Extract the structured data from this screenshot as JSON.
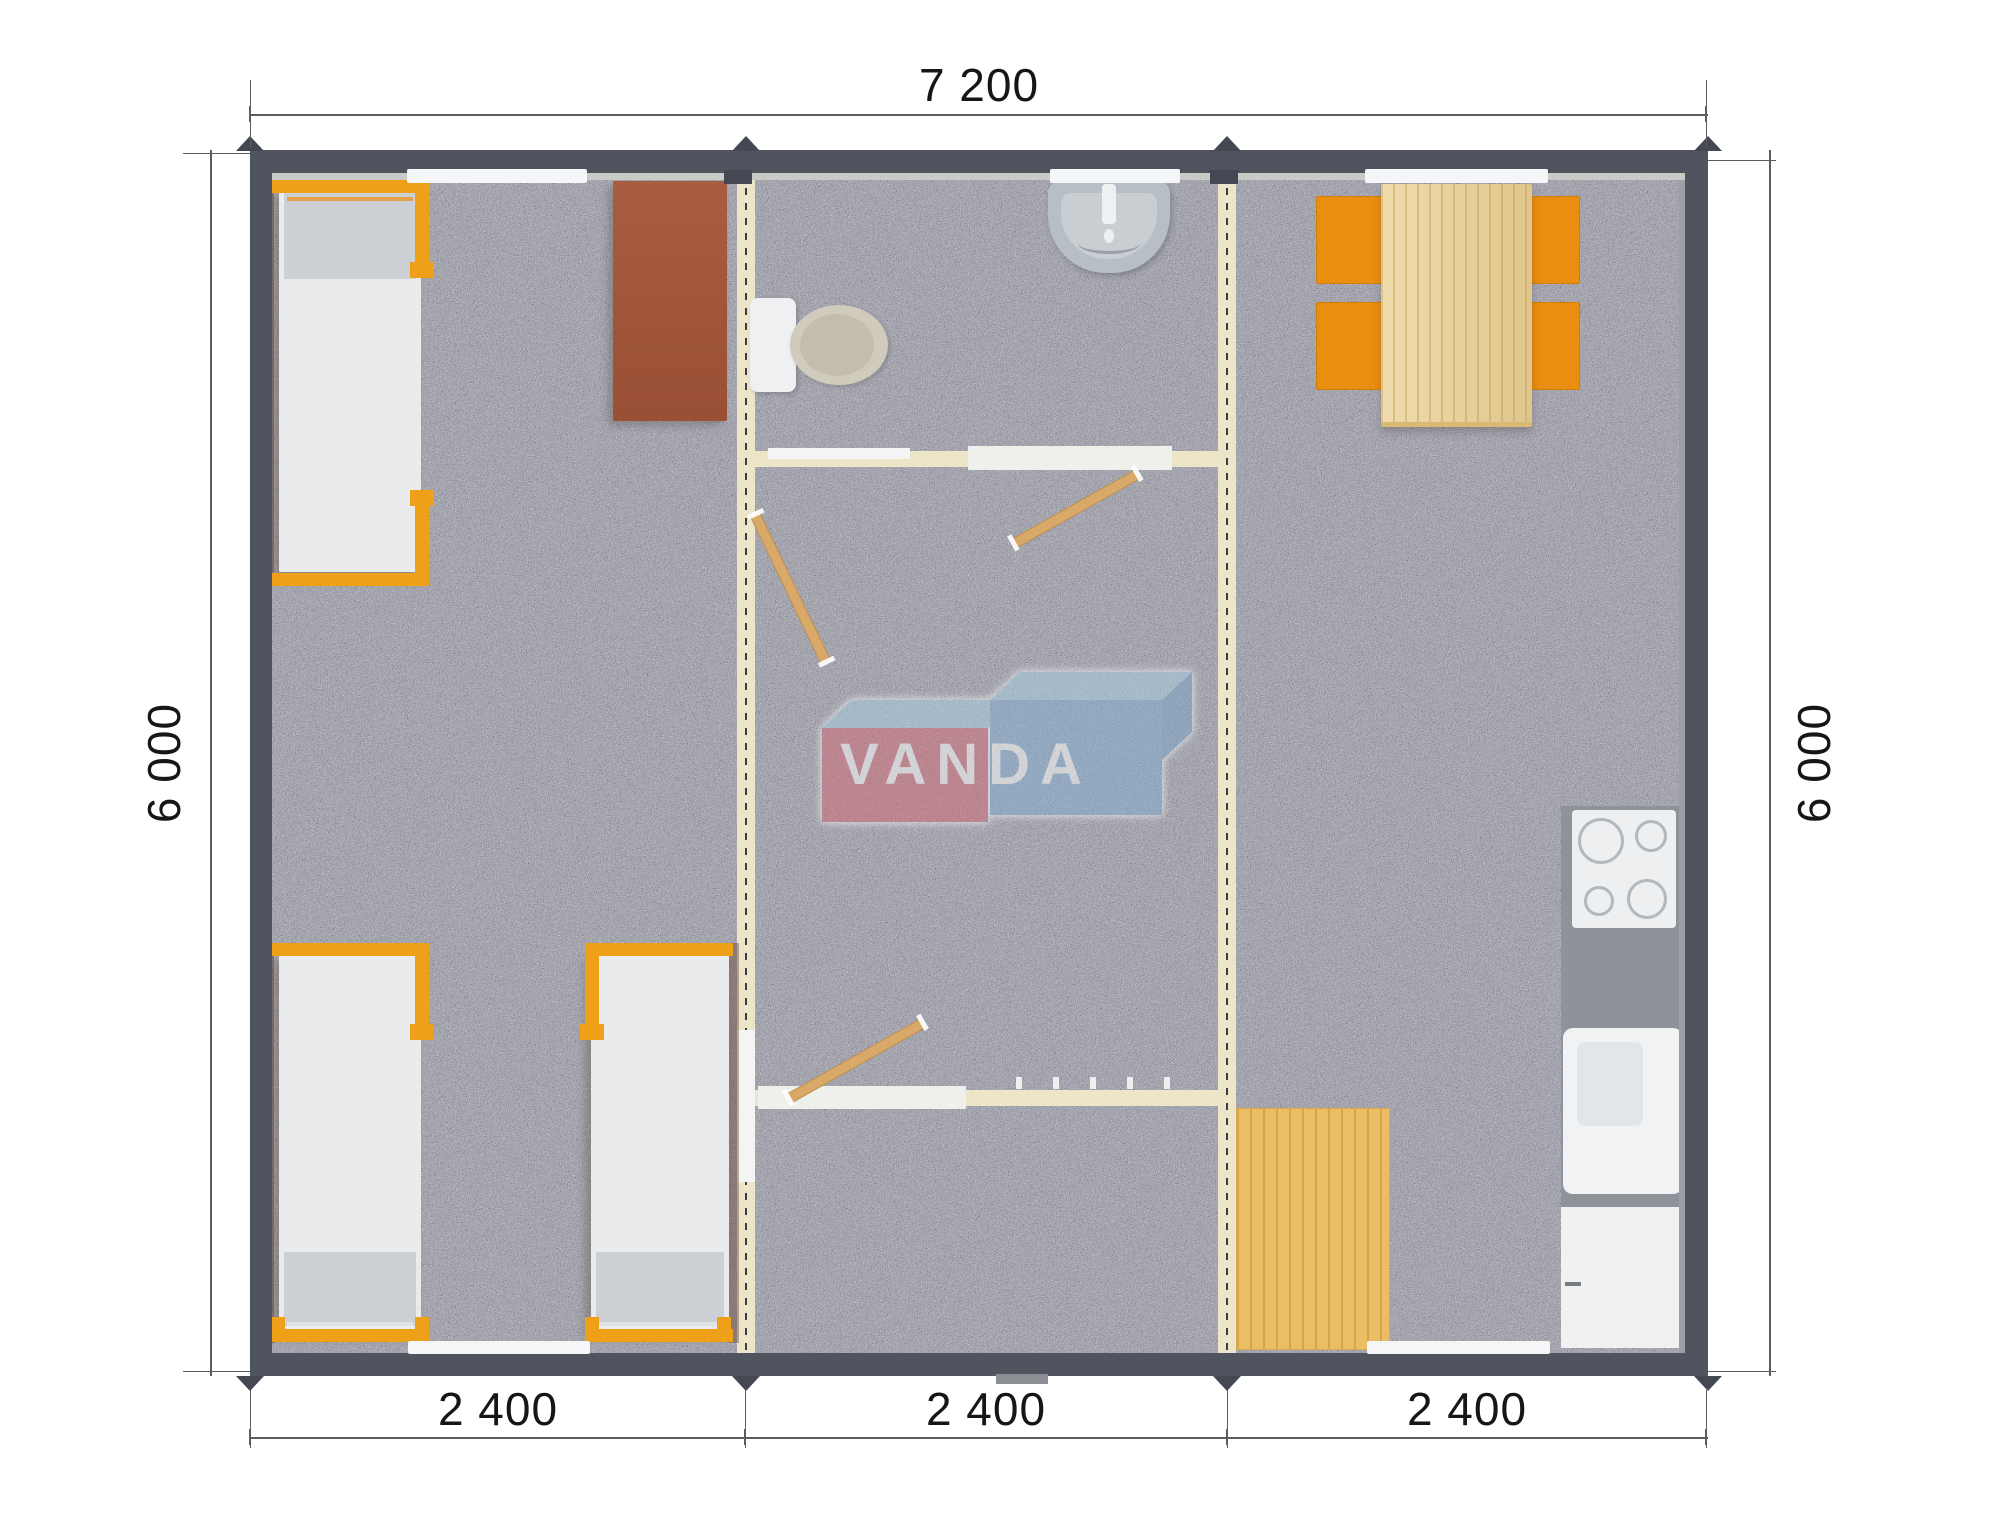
{
  "drawing": {
    "title": "modular-building-floor-plan-top-view",
    "overall_width_label": "7 200",
    "overall_depth_label_left": "6 000",
    "overall_depth_label_right": "6 000",
    "module_width_labels": [
      "2 400",
      "2 400",
      "2 400"
    ],
    "overall_width_mm": 7200,
    "overall_depth_mm": 6000,
    "module_width_mm": 2400,
    "module_count": 3
  },
  "branding": {
    "watermark": "VANDA"
  },
  "plan": {
    "modules": [
      {
        "name": "bedroom-module",
        "contents": [
          "single-bed",
          "single-bed",
          "single-bed",
          "desk"
        ]
      },
      {
        "name": "bathroom-hall-module",
        "contents": [
          "wash-basin",
          "toilet",
          "interior-door",
          "interior-door",
          "interior-door",
          "coat-hooks",
          "entry-threshold"
        ]
      },
      {
        "name": "kitchen-dining-module",
        "contents": [
          "dining-table",
          "chair",
          "chair",
          "chair",
          "chair",
          "cooktop",
          "kitchen-sink",
          "base-cabinet",
          "wood-floor-mat"
        ]
      }
    ]
  },
  "colors": {
    "wall": "#4f545e",
    "wall-dark": "#434852",
    "liner": "#c9ccc6",
    "floor": "#a5a5ad",
    "cream": "#ece5c8",
    "dash": "#3c3c44",
    "window": "#f4f6f7",
    "bed-orange": "#eda018",
    "mattress": "#e9ebed",
    "pillow": "#ccd0d5",
    "desk": "#a85c40",
    "chair": "#ea8e10",
    "wood-table": "#ecd295",
    "wood-mat": "#ecbe63",
    "counter": "#8f9298",
    "door-wood": "#d9a96a",
    "logo-red": "#d26b76",
    "logo-blue": "#84aed2",
    "logo-roof": "#a6d0e2",
    "dim-line": "#5b5c5e",
    "dim-text": "#161616"
  }
}
